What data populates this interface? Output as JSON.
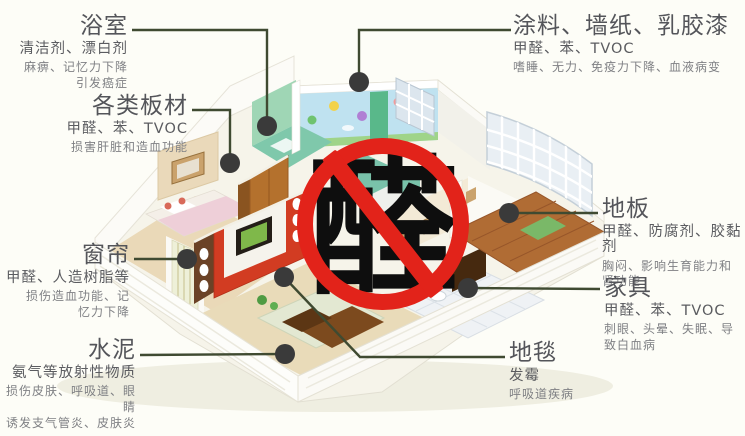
{
  "stamp": {
    "character": "醛"
  },
  "callouts": [
    {
      "id": "bathroom",
      "title": "浴室",
      "pollutants": "清洁剂、漂白剂",
      "effects": [
        "麻痹、记忆力下降",
        "引发癌症"
      ]
    },
    {
      "id": "boards",
      "title": "各类板材",
      "pollutants": "甲醛、苯、TVOC",
      "effects": [
        "损害肝脏和造血功能"
      ]
    },
    {
      "id": "curtain",
      "title": "窗帘",
      "pollutants": "甲醛、人造树脂等",
      "effects": [
        "损伤造血功能、记",
        "忆力下降"
      ]
    },
    {
      "id": "cement",
      "title": "水泥",
      "pollutants": "氨气等放射性物质",
      "effects": [
        "损伤皮肤、呼吸道、眼睛",
        "诱发支气管炎、皮肤炎"
      ]
    },
    {
      "id": "paint",
      "title": "涂料、墙纸、乳胶漆",
      "pollutants": "甲醛、苯、TVOC",
      "effects": [
        "嗜睡、无力、免疫力下降、血液病变"
      ]
    },
    {
      "id": "floor",
      "title": "地板",
      "pollutants": "甲醛、防腐剂、胶黏剂",
      "effects": [
        "胸闷、影响生育能力和",
        "肾功能"
      ]
    },
    {
      "id": "furniture",
      "title": "家具",
      "pollutants": "甲醛、苯、TVOC",
      "effects": [
        "刺眼、头晕、失眠、导",
        "致白血病"
      ]
    },
    {
      "id": "carpet",
      "title": "地毯",
      "pollutants": "发霉",
      "effects": [
        "呼吸道疾病"
      ]
    }
  ],
  "colors": {
    "stamp_red": "#e2231a",
    "leader_line": "#3f4a31",
    "marker_dot": "#3a3a3a",
    "title_text": "#54555a",
    "body_text": "#7f8084",
    "accent_wall_red": "#d23c22",
    "mural_blue": "#bfe2f0"
  }
}
